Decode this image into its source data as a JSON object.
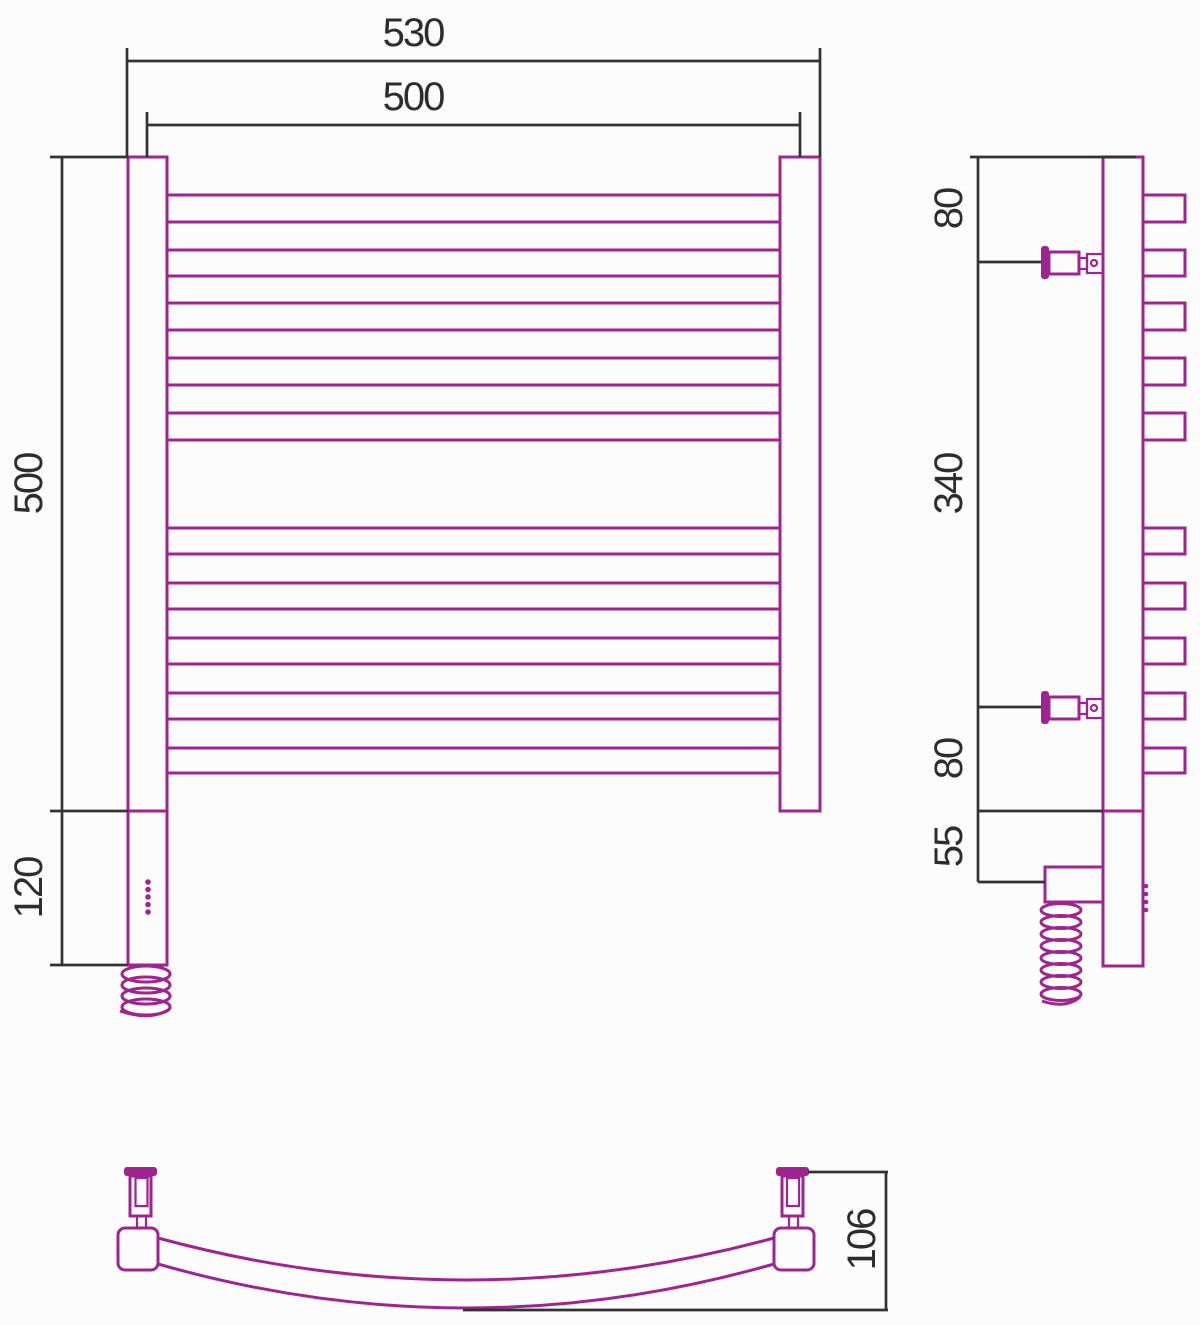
{
  "dimensions": {
    "front": {
      "overall_width": "530",
      "center_width": "500",
      "height": "500",
      "heater_height": "120"
    },
    "side": {
      "top_offset": "80",
      "bracket_spacing": "340",
      "bottom_offset": "80",
      "heater_offset": "55"
    },
    "top": {
      "depth": "106"
    }
  },
  "colors": {
    "product": "#9f2490",
    "dimension_lines": "#333333",
    "text": "#2d2d2d",
    "background": "#fcfcfc"
  }
}
